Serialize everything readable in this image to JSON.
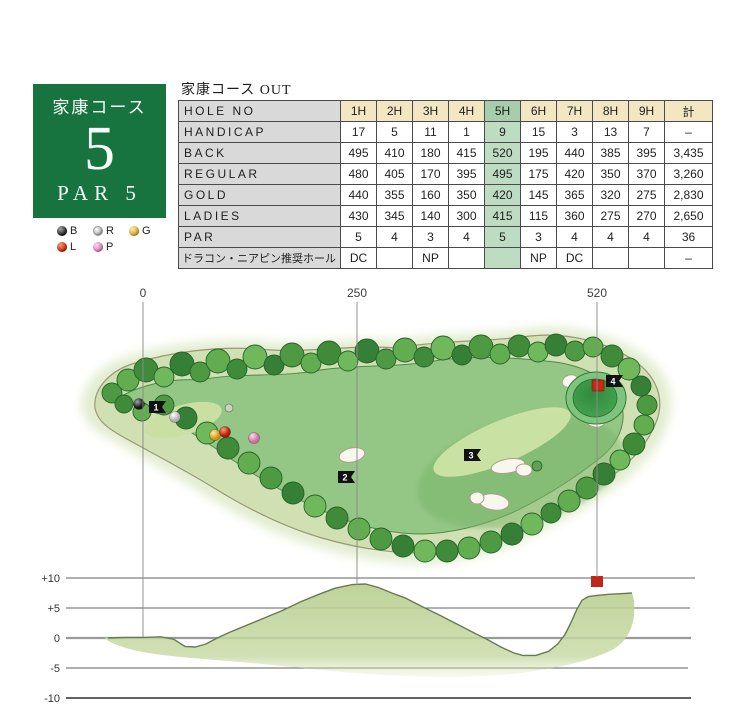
{
  "course_box": {
    "course_name": "家康コース",
    "hole_number": "5",
    "par_text": "PAR 5",
    "bg_color": "#17743f"
  },
  "tee_legend": [
    {
      "code": "B",
      "color": "#1a1a1a"
    },
    {
      "code": "R",
      "color": "#d8d8d8"
    },
    {
      "code": "G",
      "color": "#cf9512"
    },
    {
      "code": "L",
      "color": "#b51900"
    },
    {
      "code": "P",
      "color": "#d06aa8"
    }
  ],
  "score_table": {
    "title": "家康コース OUT",
    "highlight_column": "5H",
    "highlight_color": "#bddcc1",
    "header_color": "#f3e7c3",
    "rows": [
      {
        "label": "HOLE NO",
        "values": [
          "1H",
          "2H",
          "3H",
          "4H",
          "5H",
          "6H",
          "7H",
          "8H",
          "9H",
          "計"
        ]
      },
      {
        "label": "HANDICAP",
        "values": [
          "17",
          "5",
          "11",
          "1",
          "9",
          "15",
          "3",
          "13",
          "7",
          "–"
        ]
      },
      {
        "label": "BACK",
        "values": [
          "495",
          "410",
          "180",
          "415",
          "520",
          "195",
          "440",
          "385",
          "395",
          "3,435"
        ]
      },
      {
        "label": "REGULAR",
        "values": [
          "480",
          "405",
          "170",
          "395",
          "495",
          "175",
          "420",
          "350",
          "370",
          "3,260"
        ]
      },
      {
        "label": "GOLD",
        "values": [
          "440",
          "355",
          "160",
          "350",
          "420",
          "145",
          "365",
          "320",
          "275",
          "2,830"
        ]
      },
      {
        "label": "LADIES",
        "values": [
          "430",
          "345",
          "140",
          "300",
          "415",
          "115",
          "360",
          "275",
          "270",
          "2,650"
        ]
      },
      {
        "label": "PAR",
        "values": [
          "5",
          "4",
          "3",
          "4",
          "5",
          "3",
          "4",
          "4",
          "4",
          "36"
        ]
      },
      {
        "label": "ドラコン・ニアピン推奨ホール",
        "values": [
          "DC",
          "",
          "NP",
          "",
          "",
          "NP",
          "DC",
          "",
          "",
          "–"
        ]
      }
    ]
  },
  "course_map": {
    "distance_markers": [
      {
        "label": "0"
      },
      {
        "label": "250"
      },
      {
        "label": "520"
      }
    ],
    "hole_point_markers": [
      "1",
      "2",
      "3",
      "4"
    ],
    "flag_color": "#bf2718"
  },
  "chart_data": {
    "type": "area",
    "title": "",
    "ylabel": "elevation (m)",
    "ylim": [
      -10,
      10
    ],
    "y_ticks": [
      "+10",
      "+5",
      "0",
      "-5",
      "-10"
    ],
    "x_ticks_yards": [
      0,
      250,
      520
    ],
    "flag_yd": 520,
    "x_yd": [
      -40,
      -20,
      0,
      20,
      35,
      48,
      60,
      72,
      85,
      100,
      120,
      140,
      160,
      180,
      200,
      220,
      240,
      255,
      270,
      285,
      300,
      320,
      340,
      360,
      380,
      395,
      410,
      425,
      435,
      450,
      465,
      475,
      483,
      490,
      497,
      503,
      510,
      520,
      535,
      550,
      560
    ],
    "elev_m": [
      0,
      0.1,
      0.1,
      0.2,
      -0.2,
      -1.4,
      -1.5,
      -1.0,
      0,
      1.0,
      2.2,
      3.4,
      4.6,
      6.0,
      7.2,
      8.3,
      8.9,
      9.0,
      8.4,
      7.5,
      6.7,
      5.2,
      3.8,
      2.3,
      0.8,
      -0.3,
      -1.5,
      -2.5,
      -2.9,
      -2.9,
      -2.2,
      -1.0,
      0.5,
      2.5,
      4.8,
      6.3,
      6.9,
      7.1,
      7.3,
      7.4,
      7.5
    ]
  }
}
